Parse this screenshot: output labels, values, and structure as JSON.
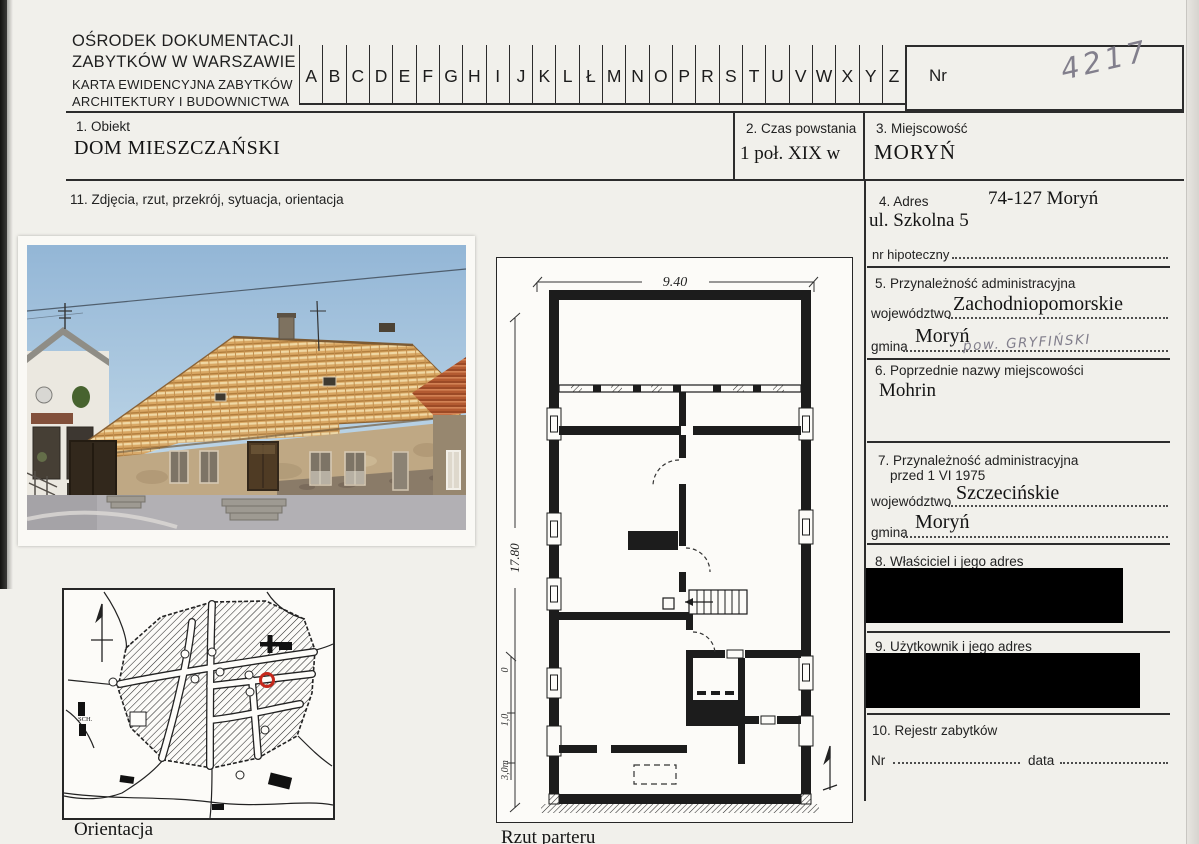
{
  "header": {
    "org_line1": "OŚRODEK DOKUMENTACJI",
    "org_line2": "ZABYTKÓW W WARSZAWIE",
    "card_line1": "KARTA EWIDENCYJNA ZABYTKÓW",
    "card_line2": "ARCHITEKTURY I BUDOWNICTWA",
    "alphabet": [
      "A",
      "B",
      "C",
      "D",
      "E",
      "F",
      "G",
      "H",
      "I",
      "J",
      "K",
      "L",
      "Ł",
      "M",
      "N",
      "O",
      "P",
      "R",
      "S",
      "T",
      "U",
      "V",
      "W",
      "X",
      "Y",
      "Z"
    ],
    "nr_label": "Nr",
    "card_number": "4217"
  },
  "fields": {
    "obiekt": {
      "label": "1. Obiekt",
      "value": "DOM MIESZCZAŃSKI"
    },
    "czas_powstania": {
      "label": "2. Czas powstania",
      "value": "1 poł. XIX w"
    },
    "miejscowosc": {
      "label": "3. Miejscowość",
      "value": "MORYŃ"
    },
    "zdjecia": {
      "label": "11. Zdjęcia, rzut, przekrój, sytuacja, orientacja"
    },
    "adres": {
      "label": "4. Adres",
      "value_number": "74-127 Moryń",
      "value_street": "ul. Szkolna 5",
      "nr_hipoteczny_label": "nr hipoteczny"
    },
    "przynaleznosc": {
      "label": "5. Przynależność administracyjna",
      "wojewodztwo_label": "województwo",
      "wojewodztwo_value": "Zachodniopomorskie",
      "gmina_label": "gmina",
      "gmina_value": "Moryń",
      "handwritten_note": "pow. GRYFIŃSKI"
    },
    "poprzednie_nazwy": {
      "label": "6. Poprzednie nazwy miejscowości",
      "value": "Mohrin"
    },
    "przynaleznosc_1975": {
      "label_line1": "7. Przynależność administracyjna",
      "label_line2": "przed  1 VI 1975",
      "wojewodztwo_label": "województwo",
      "wojewodztwo_value": "Szczecińskie",
      "gmina_label": "gmina",
      "gmina_value": "Moryń"
    },
    "wlasciciel": {
      "label": "8. Właściciel i jego adres",
      "redacted": true
    },
    "uzytkownik": {
      "label": "9. Użytkownik i jego adres",
      "redacted": true
    },
    "rejestr": {
      "label": "10. Rejestr zabytków",
      "nr_label": "Nr",
      "data_label": "data"
    }
  },
  "figures": {
    "map_caption": "Orientacja",
    "map_school_label": "SCH.",
    "plan_caption": "Rzut parteru",
    "plan_width_dim": "9.40",
    "plan_height_dim": "17.80",
    "plan_scale_zero": "0",
    "plan_scale_one": "1,0",
    "plan_scale_three": "3,0m"
  },
  "colors": {
    "redaction": "#000000",
    "marker_red": "#c5281c",
    "pencil_grey": "#827f8c"
  }
}
